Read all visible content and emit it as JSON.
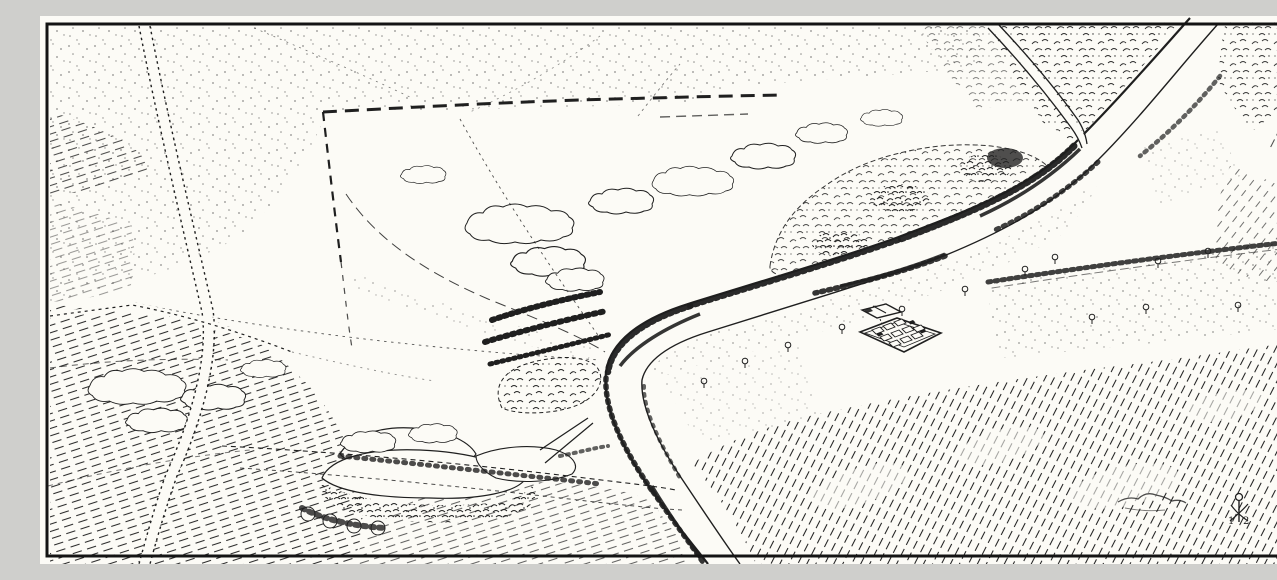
{
  "figure": {
    "kind": "pen-and-ink bird's-eye-view landscape drawing",
    "aria_label": "Bird's-eye view ink drawing of a river valley: winding tree-lined river, hatched fields, dashed enclosure earthwork, woods, a scrub-covered mound, a small rectangular building complex near the river, and roads"
  },
  "colors": {
    "ink": "#1f1f1f",
    "paper": "#fcfbf6",
    "frame": "#141414"
  },
  "monogram": {
    "digit_left": "1",
    "digit_right": "2"
  },
  "scene": {
    "features": [
      "border-frame",
      "river",
      "river-bank-trees",
      "left-road",
      "riverside-road",
      "enclosure-hedge",
      "enclosure-boundary",
      "field-tracks",
      "top-right-woods",
      "wooded-thicket-hill",
      "scrub-cloud-outlines",
      "riverside-grove",
      "copse",
      "mound-with-scrub",
      "building-complex-plan",
      "hatched-fields",
      "stippled-meadows",
      "hedgerow",
      "scattered-trees",
      "artist-monogram"
    ]
  }
}
